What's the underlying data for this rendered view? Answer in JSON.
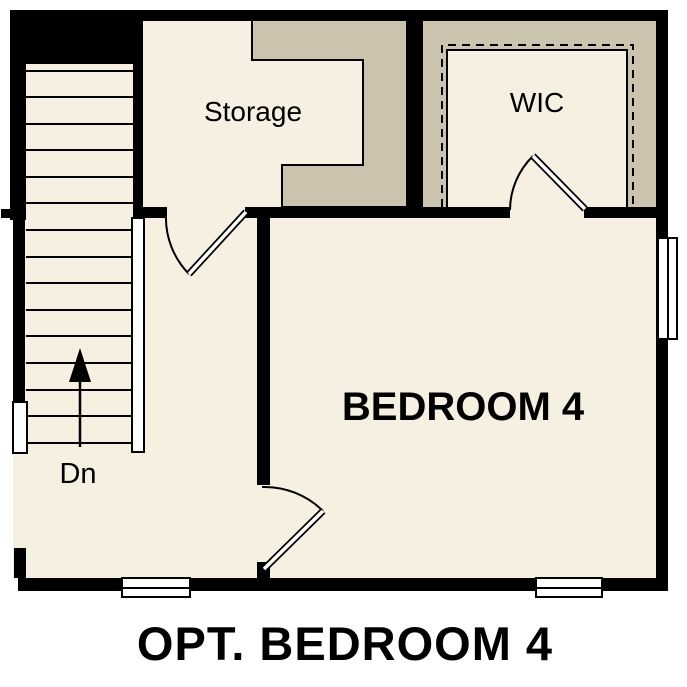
{
  "plan_title": "OPT. BEDROOM 4",
  "rooms": {
    "storage": {
      "label": "Storage"
    },
    "wic": {
      "label": "WIC"
    },
    "bedroom": {
      "label": "BEDROOM 4"
    }
  },
  "stairs": {
    "direction_label": "Dn"
  },
  "colors": {
    "page_background": "#FFFFFF",
    "floor": "#F6F0E3",
    "closet_shade": "#CBC3AD",
    "wall": "#000000",
    "window": "#FFFFFF",
    "text": "#000000"
  }
}
